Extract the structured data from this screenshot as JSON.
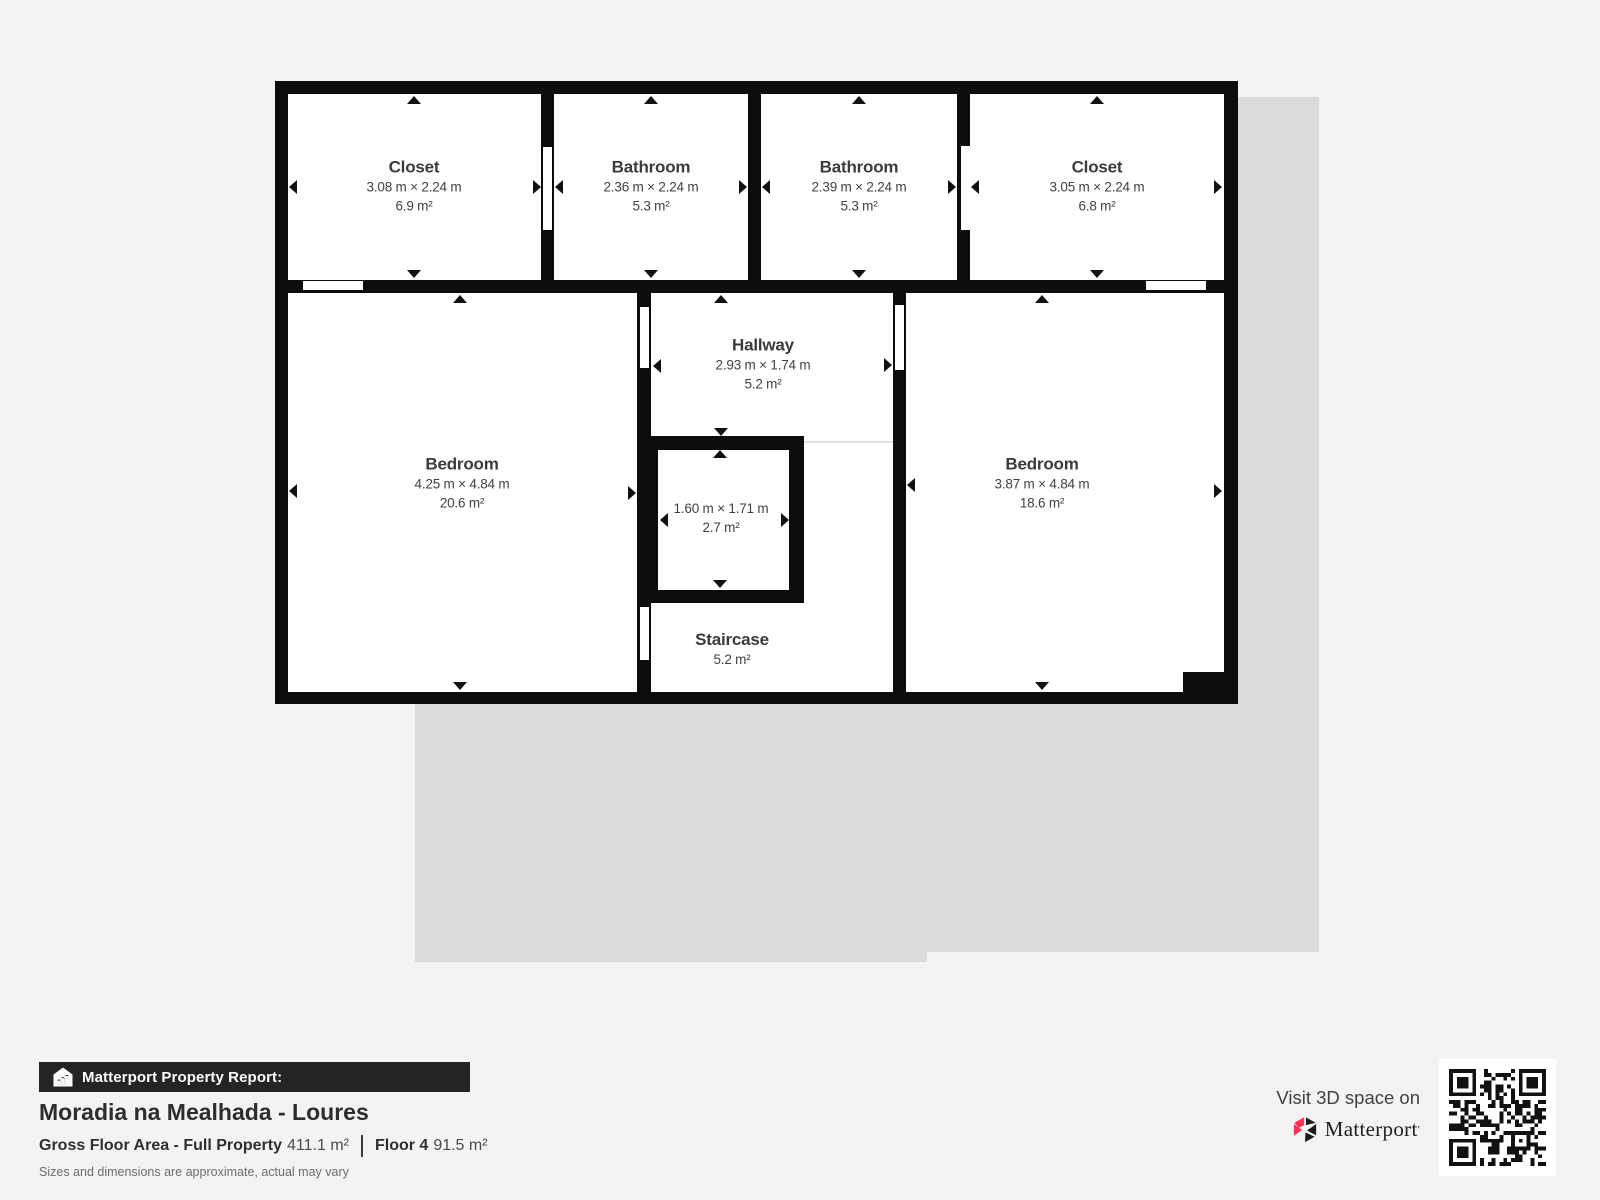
{
  "plan": {
    "rooms": [
      {
        "name": "Closet",
        "dims": "3.08 m × 2.24 m",
        "area": "6.9 m²"
      },
      {
        "name": "Bathroom",
        "dims": "2.36 m × 2.24 m",
        "area": "5.3 m²"
      },
      {
        "name": "Bathroom",
        "dims": "2.39 m × 2.24 m",
        "area": "5.3 m²"
      },
      {
        "name": "Closet",
        "dims": "3.05 m × 2.24 m",
        "area": "6.8 m²"
      },
      {
        "name": "Bedroom",
        "dims": "4.25 m × 4.84 m",
        "area": "20.6 m²"
      },
      {
        "name": "Hallway",
        "dims": "2.93 m × 1.74 m",
        "area": "5.2 m²"
      },
      {
        "name": "",
        "dims": "1.60 m × 1.71 m",
        "area": "2.7 m²"
      },
      {
        "name": "Staircase",
        "dims": "",
        "area": "5.2 m²"
      },
      {
        "name": "Bedroom",
        "dims": "3.87 m × 4.84 m",
        "area": "18.6 m²"
      }
    ]
  },
  "footer": {
    "report_label": "Matterport Property Report:",
    "property_title": "Moradia na Mealhada - Loures",
    "gfa_label": "Gross Floor Area - Full Property",
    "gfa_value": "411.1 m²",
    "floor_label": "Floor 4",
    "floor_value": "91.5 m²",
    "disclaimer": "Sizes and dimensions are approximate, actual may vary"
  },
  "cta": {
    "visit_label": "Visit 3D space on",
    "brand_name": "Matterport",
    "brand_mark": "′"
  },
  "colors": {
    "background": "#f4f3f1",
    "silhouette": "#dbdbda",
    "wall": "#0d0d0d",
    "room_fill": "#ffffff",
    "label_text": "#3e3e3e",
    "brand_pink": "#ff3158",
    "bar_background": "#242424"
  }
}
